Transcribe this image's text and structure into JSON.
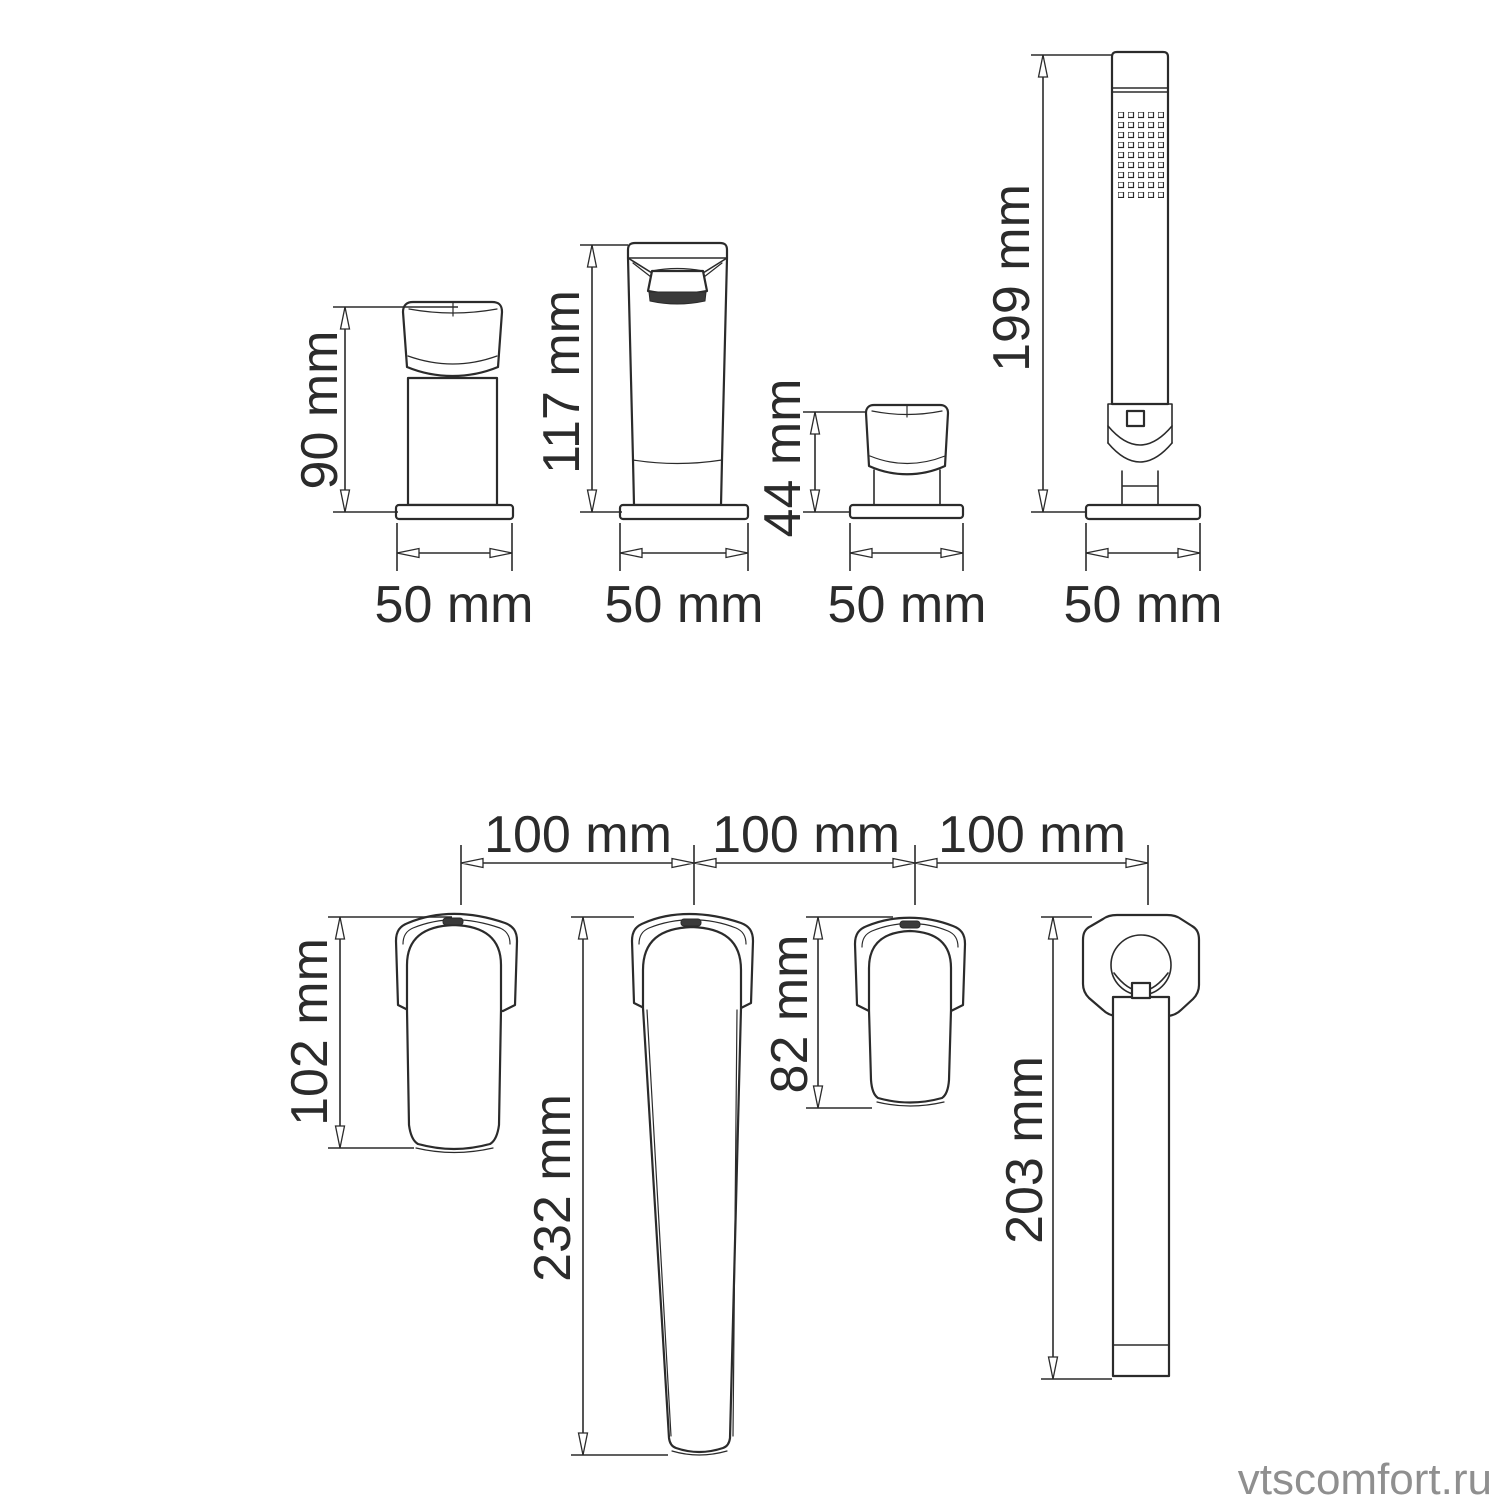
{
  "drawing": {
    "top_row": {
      "items": [
        {
          "id": "handle-valve-side",
          "height": "90 mm",
          "width": "50 mm"
        },
        {
          "id": "spout-side",
          "height": "117 mm",
          "width": "50 mm"
        },
        {
          "id": "small-valve-side",
          "height": "44 mm",
          "width": "50 mm"
        },
        {
          "id": "hand-shower-side",
          "height": "199 mm",
          "width": "50 mm"
        }
      ]
    },
    "bottom_row": {
      "spacings": [
        "100 mm",
        "100 mm",
        "100 mm"
      ],
      "items": [
        {
          "id": "handle-valve-top",
          "length": "102 mm"
        },
        {
          "id": "spout-top",
          "length": "232 mm"
        },
        {
          "id": "small-valve-top",
          "length": "82 mm"
        },
        {
          "id": "hand-shower-top",
          "length": "203 mm"
        }
      ]
    },
    "colors": {
      "line": "#2b2b2b",
      "watermark": "#8f8f8f",
      "background": "#ffffff"
    }
  },
  "watermark": {
    "text": "vtscomfort.ru"
  }
}
